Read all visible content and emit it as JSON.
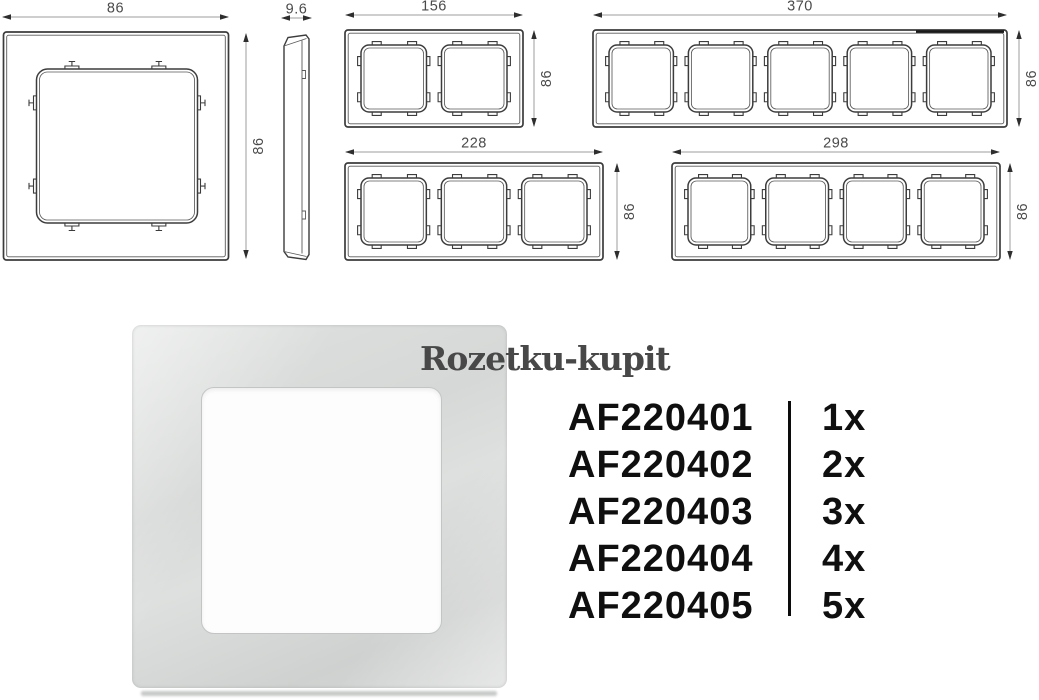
{
  "watermark": {
    "text": "Rozetku-kupit"
  },
  "product_table": {
    "rows": [
      {
        "code": "AF220401",
        "qty": "1x"
      },
      {
        "code": "AF220402",
        "qty": "2x"
      },
      {
        "code": "AF220403",
        "qty": "3x"
      },
      {
        "code": "AF220404",
        "qty": "4x"
      },
      {
        "code": "AF220405",
        "qty": "5x"
      }
    ]
  },
  "technical_drawings": {
    "side_view_depth_mm": "9.6",
    "frames": [
      {
        "id": "frame-1gang",
        "gangs": 1,
        "width_mm": "86",
        "height_mm": "86"
      },
      {
        "id": "frame-2gang",
        "gangs": 2,
        "width_mm": "156",
        "height_mm": "86"
      },
      {
        "id": "frame-3gang",
        "gangs": 3,
        "width_mm": "228",
        "height_mm": "86"
      },
      {
        "id": "frame-4gang",
        "gangs": 4,
        "width_mm": "298",
        "height_mm": "86"
      },
      {
        "id": "frame-5gang",
        "gangs": 5,
        "width_mm": "370",
        "height_mm": "86"
      }
    ]
  },
  "colors": {
    "drawing_line": "#3c3c3c",
    "drawing_thin": "#5a5a5a",
    "dim_line": "#9e9e9e",
    "dim_arrow": "#2e2e2e",
    "dim_text": "#4a4a4a",
    "table_text": "#0f0f0f",
    "watermark_text": "#484848",
    "photo_frame": "#d6d8d7",
    "photo_opening": "#fdfdfd"
  }
}
